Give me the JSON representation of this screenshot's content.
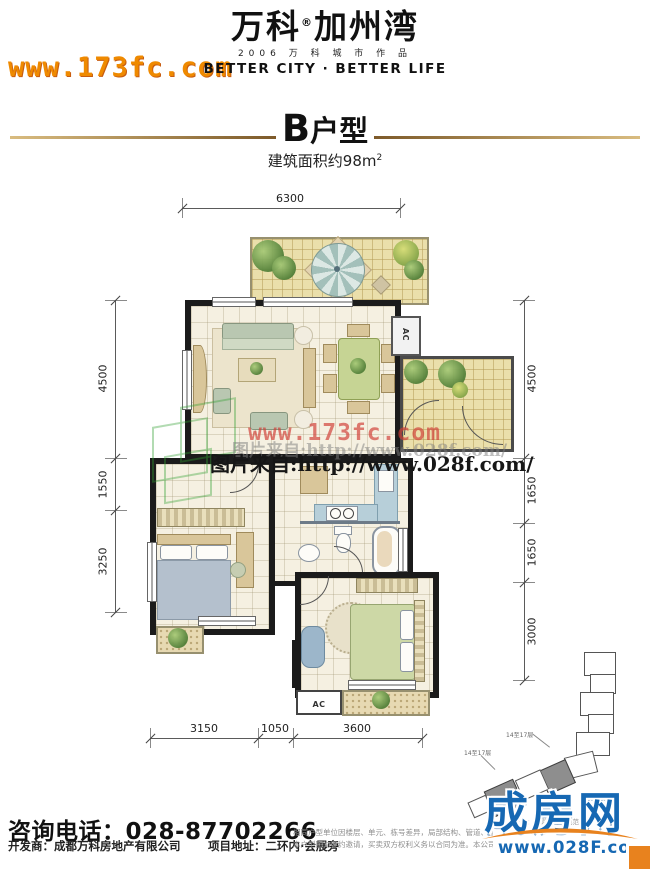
{
  "colors": {
    "accent_gold": "#a97c3b",
    "site_orange": "#ef8a00",
    "watermark_red": "#d03e37",
    "logo_blue": "#1668b3",
    "logo_orange": "#e8821e"
  },
  "header": {
    "site_watermark": "www.173fc.com",
    "brand": {
      "name": "万科",
      "reg": "®",
      "project": "加州湾",
      "year_line": "2006 万 科 城 市 作 品",
      "slogan": "BETTER CITY · BETTER LIFE"
    }
  },
  "title": {
    "unit_letter": "B",
    "unit_suffix": "户型",
    "area_text": "建筑面积约98m",
    "area_sup": "2"
  },
  "plan": {
    "dim_top": "6300",
    "dims_left": [
      "4500",
      "1550",
      "3250"
    ],
    "dims_right": [
      "4500",
      "1650",
      "1650",
      "3000"
    ],
    "dims_bottom": [
      "3150",
      "1050",
      "3600"
    ],
    "ac_top": "AC",
    "ac_bottom": "AC",
    "watermark_red": "www.173fc.com",
    "watermark_gray": "图片来自:http://www.028f.com/",
    "watermark_black": "图片来自:http://www.028f.com/",
    "keyplan": {
      "label_a": "14至17层",
      "label_b": "14至17层",
      "note": "说明：阴影内为着色范围"
    }
  },
  "footer": {
    "phone_label": "咨询电话：",
    "phone_number": "028-87702266",
    "developer": "开发商：成都万科房地产有限公司",
    "address": "项目地址：二环内·会展旁",
    "disclaimer_line1": "相同户型单位因楼层、单元、栋号差异，局部结构、管道、窗",
    "disclaimer_line2": "本户型图为要约邀请，买卖双方权利义务以合同为准。本公司",
    "logo": {
      "name": "成房网",
      "site": "www.028F.com"
    }
  }
}
